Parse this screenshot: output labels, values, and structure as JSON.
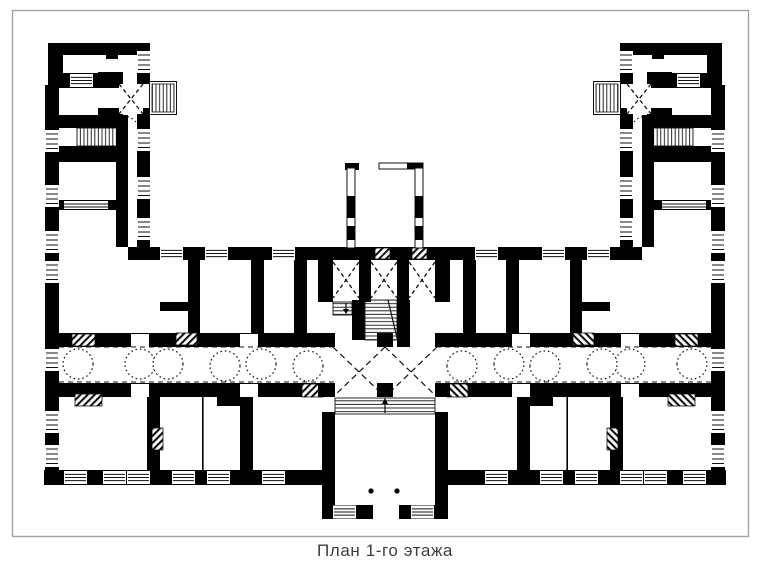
{
  "caption": "План 1-го этажа",
  "colors": {
    "ink": "#111111",
    "frame_border": "#a3a3a8",
    "background": "#ffffff"
  }
}
